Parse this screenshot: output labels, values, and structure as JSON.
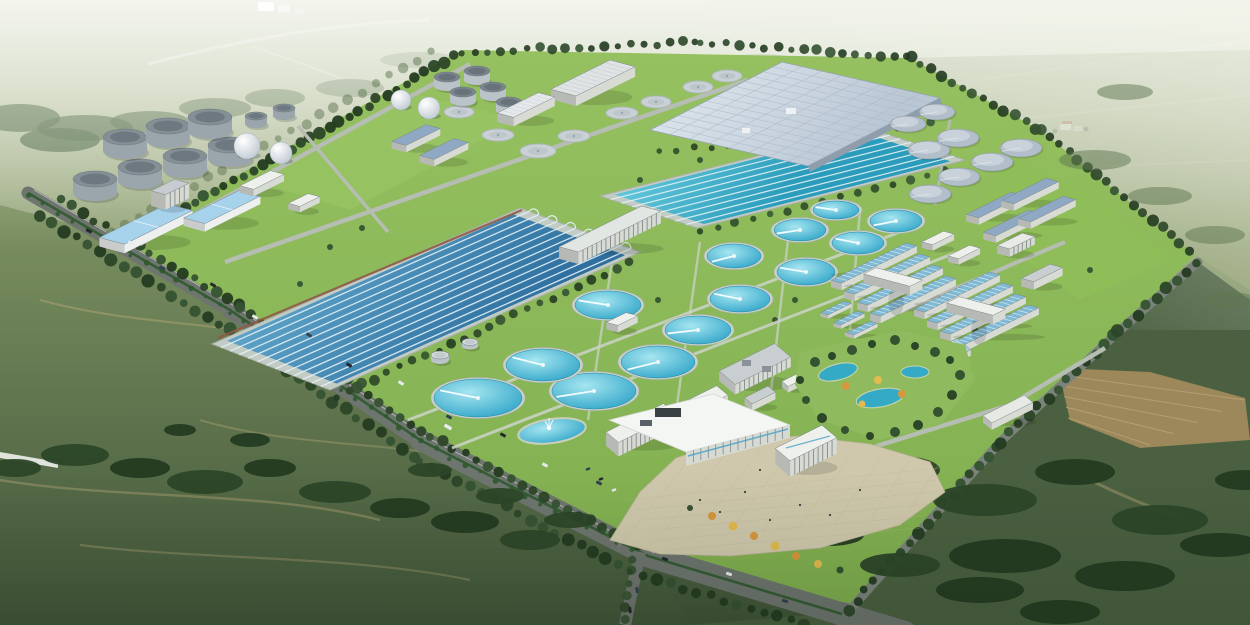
{
  "document": {
    "description": "Aerial oblique 3D architectural rendering of a large wastewater treatment plant campus: rectangular aeration basins, circular clarifiers, digester tanks, spherical gas holders, a covered treatment hall, process buildings and an administration plaza, surrounded by tree-lined roads and green farmland under atmospheric haze."
  },
  "palette": {
    "haze_top": "#e4e8d9",
    "haze_mid": "#c3ccae",
    "field_light": "#8a9c6d",
    "field_mid": "#55694a",
    "field_dark": "#3f5438",
    "left_field_top": "#7c9161",
    "left_field_bottom": "#415639",
    "right_field": "#9aa87c",
    "plow_tan": "#a08a5c",
    "plow_line": "#b8a678",
    "track_tan": "#b9a97b",
    "tree_dark": "#2c4628",
    "tree_mid": "#355231",
    "tree_deep": "#243b21",
    "tree_hazy": "#5d7550",
    "lawn_top": "#96c161",
    "lawn_bottom": "#7fae4e",
    "lawn_bright": "#8fbe58",
    "road_dark": "#6e756f",
    "road_mid": "#7c837c",
    "road_light": "#b6bdb2",
    "road_pale": "#ccd4c9",
    "road_white": "#e9ece2",
    "median_green": "#2f5a2e",
    "basin_rim": "#c2cbc4",
    "basin_blue_light": "#63a9cd",
    "basin_blue_dark": "#2e6f9f",
    "lane_white": "#e3f1f6",
    "teal_light": "#66cadd",
    "teal_dark": "#2b9cbb",
    "clar_center": "#a6e6f0",
    "clar_edge": "#2fa4c8",
    "clar_rim": "#c9d2c9",
    "cover_light": "#d9e2ea",
    "cover_dark": "#b9c6d3",
    "cover_line": "#a9b8c7",
    "cover_wall": "#8f9dac",
    "flat_tank": "#c9d1d5",
    "flat_rim": "#aeb7ba",
    "gray_clar": "#b2bec9",
    "gray_clar_hi": "#cdd6dd",
    "tank_side": "#9aa6ac",
    "tank_side_light": "#b9c3c8",
    "tank_top": "#848f96",
    "tank_top_dark": "#6e7880",
    "sphere_hi": "#ffffff",
    "sphere_lo": "#b9c4cd",
    "bldg_white": "#eef0ec",
    "bldg_wall": "#d7dbd4",
    "roof_blue": "#a6d2ec",
    "roof_slate": "#8fa9c4",
    "roof_teal_stripe": "#7fb9d4",
    "roof_gray": "#c9cfd0",
    "window_dark": "#5f686e",
    "glass_blue": "#4fa3c8",
    "plaza": "#cfc8ac",
    "plaza_line": "#bdb493",
    "pond_teal": "#35aac6",
    "autumn_orange": "#d7973c",
    "autumn_yellow": "#e2bb4e",
    "car_dark": "#23282c",
    "car_white": "#e6eaec",
    "car_navy": "#33424f",
    "canopy_shadow": "#3c4349",
    "red_walk": "#8f5a46",
    "farm_red_roof": "#b05a40",
    "white": "#ffffff"
  },
  "scene": {
    "view": "aerial-oblique",
    "inventory": {
      "gas_holder_spheres": 4,
      "digester_tanks": 9,
      "silo_tanks": 5,
      "small_storage_tanks": 2,
      "flat_covered_tanks": 8,
      "covered_clarifiers": 8,
      "open_clarifiers": 13,
      "aeration_basin_complexes": 2,
      "covered_treatment_halls": 1,
      "administration_buildings": 2,
      "ornamental_ponds": 4
    }
  }
}
